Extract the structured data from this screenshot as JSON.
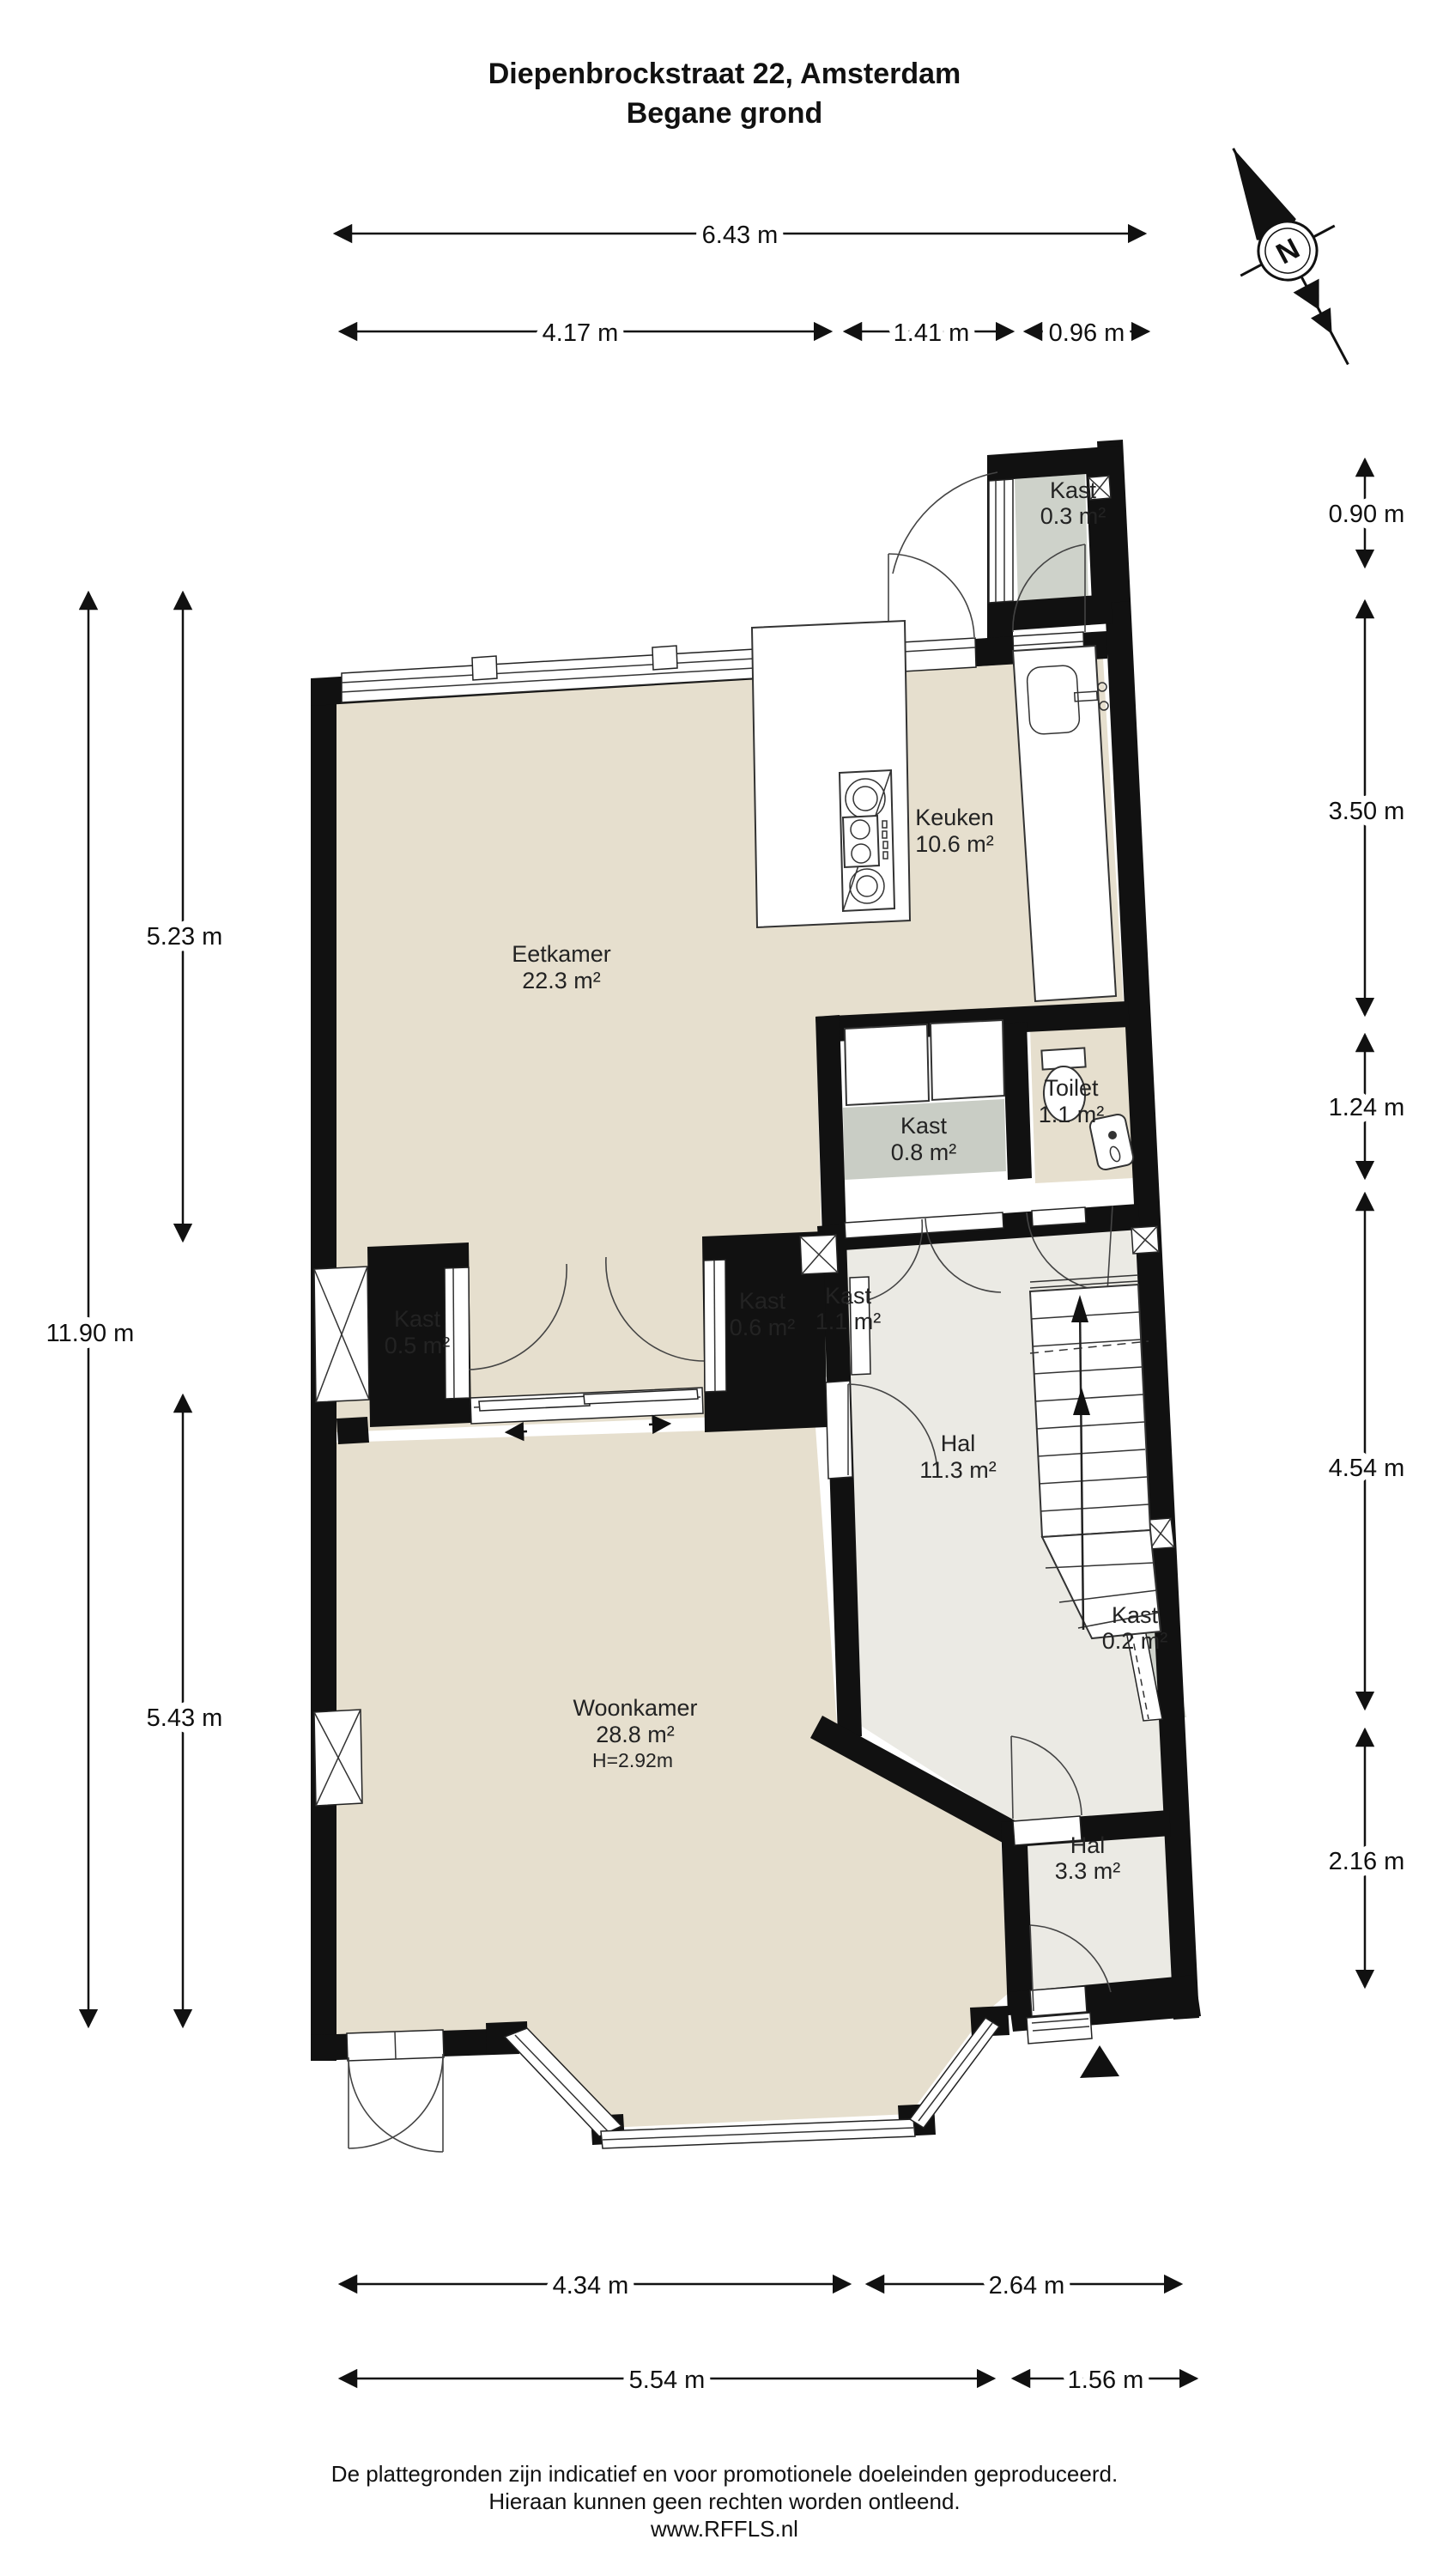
{
  "title": {
    "line1": "Diepenbrockstraat 22, Amsterdam",
    "line2": "Begane grond"
  },
  "compass": {
    "north_label": "N"
  },
  "rooms": {
    "kast03": {
      "name": "Kast",
      "area": "0.3 m²"
    },
    "keuken": {
      "name": "Keuken",
      "area": "10.6 m²"
    },
    "eetkamer": {
      "name": "Eetkamer",
      "area": "22.3 m²"
    },
    "toilet": {
      "name": "Toilet",
      "area": "1.1 m²"
    },
    "kast08": {
      "name": "Kast",
      "area": "0.8 m²"
    },
    "kast05": {
      "name": "Kast",
      "area": "0.5 m²"
    },
    "kast06": {
      "name": "Kast",
      "area": "0.6 m²"
    },
    "kast11": {
      "name": "Kast",
      "area": "1.1 m²"
    },
    "hal": {
      "name": "Hal",
      "area": "11.3 m²"
    },
    "kast02": {
      "name": "Kast",
      "area": "0.2 m²"
    },
    "woonkamer": {
      "name": "Woonkamer",
      "area": "28.8 m²",
      "height": "H=2.92m"
    },
    "hal33": {
      "name": "Hal",
      "area": "3.3 m²"
    }
  },
  "dimensions": {
    "top": [
      "6.43 m",
      "4.17 m",
      "1.41 m",
      "0.96 m"
    ],
    "left": [
      "11.90 m",
      "5.23 m",
      "5.43 m"
    ],
    "right": [
      "0.90 m",
      "3.50 m",
      "1.24 m",
      "4.54 m",
      "2.16 m"
    ],
    "bottom": [
      "4.34 m",
      "2.64 m",
      "5.54 m",
      "1.56 m"
    ]
  },
  "footer": {
    "line1": "De plattegronden zijn indicatief en voor promotionele doeleinden geproduceerd.",
    "line2": "Hieraan kunnen geen rechten worden ontleend.",
    "line3": "www.RFFLS.nl"
  },
  "colors": {
    "floor_living": "#e6dfce",
    "floor_hal": "#ebeae4",
    "floor_kast": "#ced2ca",
    "walls": "#111111"
  }
}
